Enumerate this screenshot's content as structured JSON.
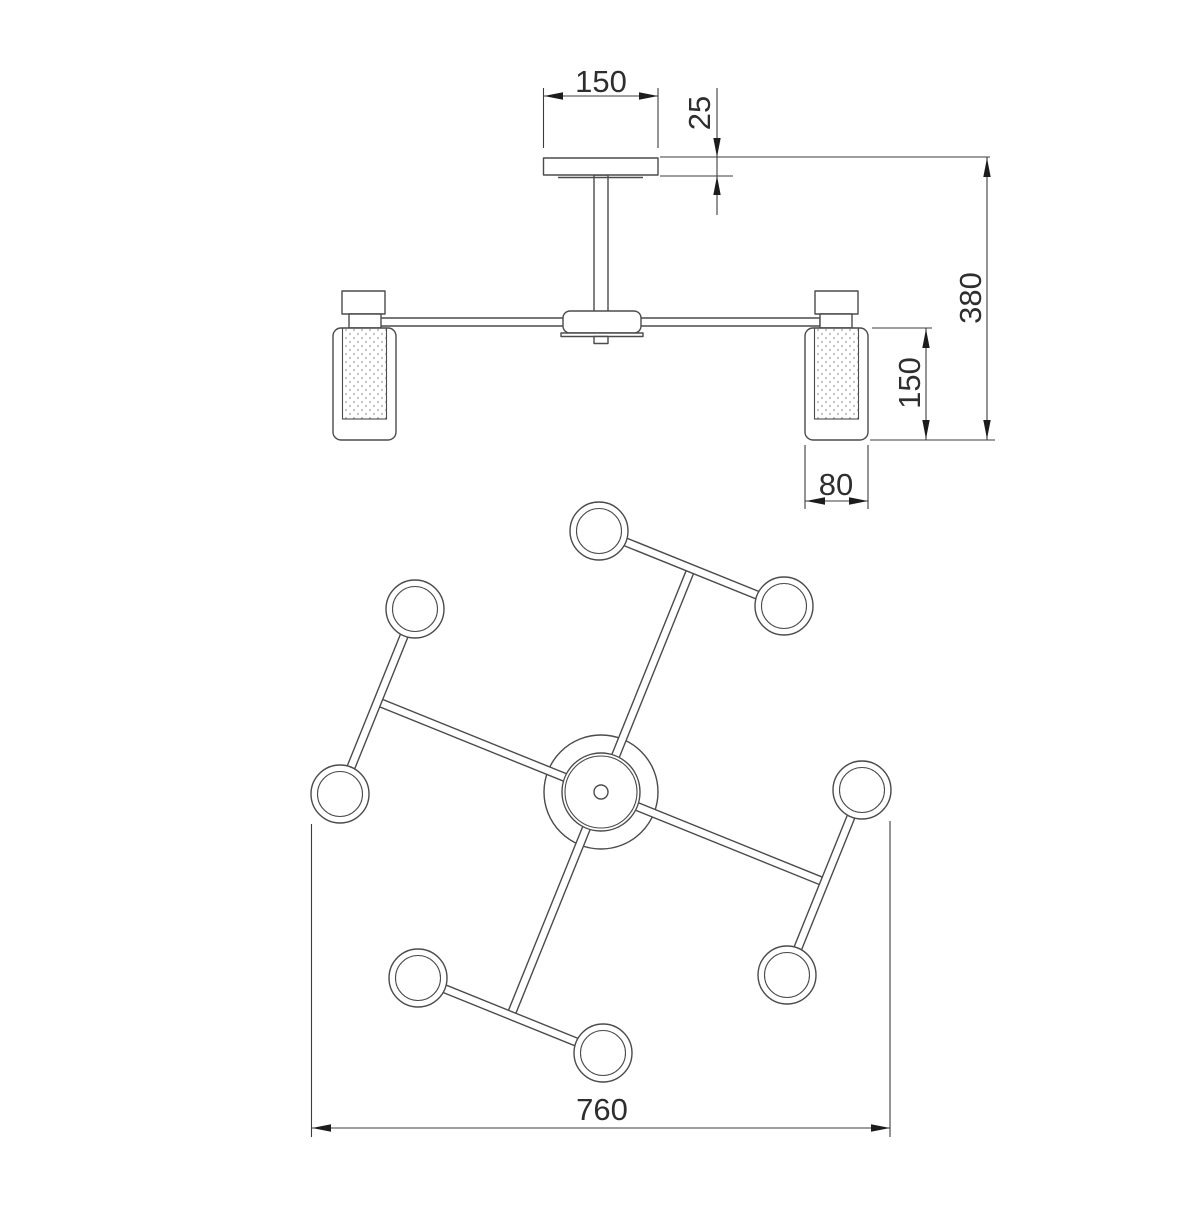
{
  "page": {
    "background": "#ffffff"
  },
  "drawing": {
    "colors": {
      "line": "#4b4b4b",
      "dimension_line": "#3d3d3d",
      "arrow": "#1c1c1c",
      "text": "#2e2e2e",
      "stipple_dots": "#9a9a9a"
    },
    "views": {
      "front_elevation": {
        "name": "front-elevation",
        "dimensions": {
          "canopy_width": "150",
          "canopy_height": "25",
          "overall_height": "380",
          "shade_height": "150",
          "shade_diameter": "80"
        }
      },
      "top_plan": {
        "name": "top-plan",
        "dimensions": {
          "overall_width": "760"
        }
      }
    }
  }
}
